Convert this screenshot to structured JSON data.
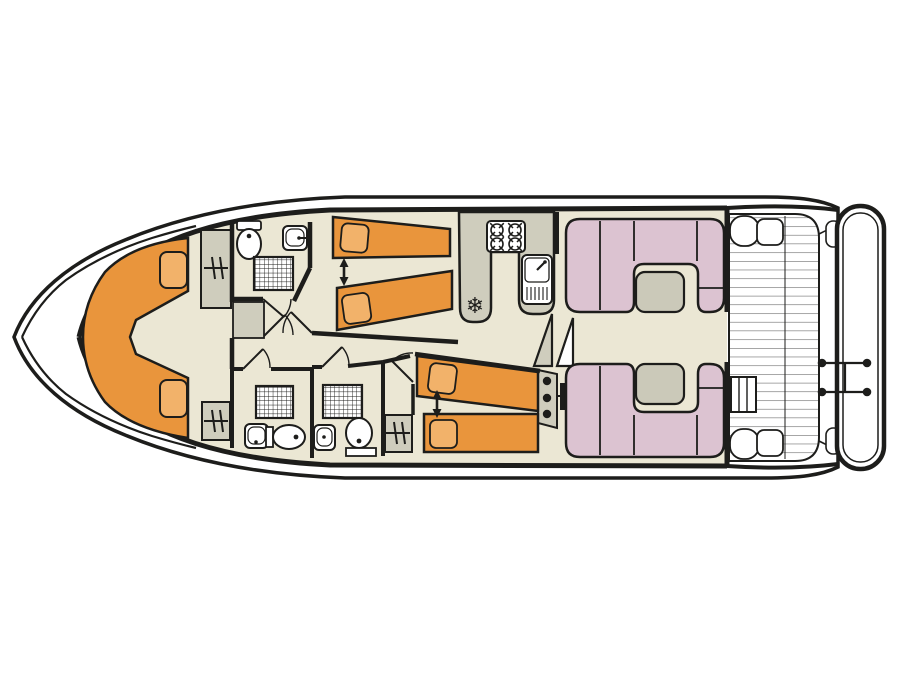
{
  "colors": {
    "outline": "#1d1d1b",
    "floor": "#EBE7D4",
    "furniture_orange": "#E9953C",
    "pillow_orange": "#F2B26A",
    "cabinet_gray": "#CFCDBD",
    "sofa_pink": "#DCC3D1",
    "table_gray": "#CBC9B9",
    "slat_gray": "#5f5f5f",
    "white": "#ffffff",
    "background": "#ffffff"
  },
  "icons": {
    "fridge_glyph": "❄"
  },
  "plan": {
    "type": "houseboat-floor-plan",
    "orientation": "bow-left",
    "areas": [
      {
        "name": "foredeck",
        "fixtures": []
      },
      {
        "name": "bow-lounge",
        "fixtures": [
          "v-shaped-berth",
          "cushion",
          "cushion",
          "wardrobe",
          "wardrobe"
        ]
      },
      {
        "name": "bathroom-forward",
        "fixtures": [
          "toilet",
          "washbasin",
          "shower"
        ]
      },
      {
        "name": "twin-cabin-forward",
        "fixtures": [
          "single-bed",
          "single-bed",
          "sliding-beds-arrow"
        ]
      },
      {
        "name": "bathroom-mid-port",
        "fixtures": [
          "toilet",
          "washbasin",
          "shower"
        ]
      },
      {
        "name": "bathroom-mid-starboard",
        "fixtures": [
          "toilet",
          "washbasin",
          "shower"
        ]
      },
      {
        "name": "twin-cabin-mid",
        "fixtures": [
          "single-bed",
          "single-bed",
          "sliding-beds-arrow",
          "wardrobe"
        ]
      },
      {
        "name": "galley",
        "fixtures": [
          "hob-4-burner",
          "sink-with-drainer",
          "fridge"
        ]
      },
      {
        "name": "companionway",
        "fixtures": [
          "steps",
          "helm-console",
          "steering-wheel"
        ]
      },
      {
        "name": "saloon-dinette",
        "fixtures": [
          "u-sofa",
          "table",
          "u-sofa",
          "table"
        ]
      },
      {
        "name": "aft-deck",
        "fixtures": [
          "slatted-floor",
          "bench",
          "bench",
          "deck-steps"
        ]
      },
      {
        "name": "swim-platform",
        "fixtures": [
          "stern-ladder"
        ]
      }
    ]
  }
}
